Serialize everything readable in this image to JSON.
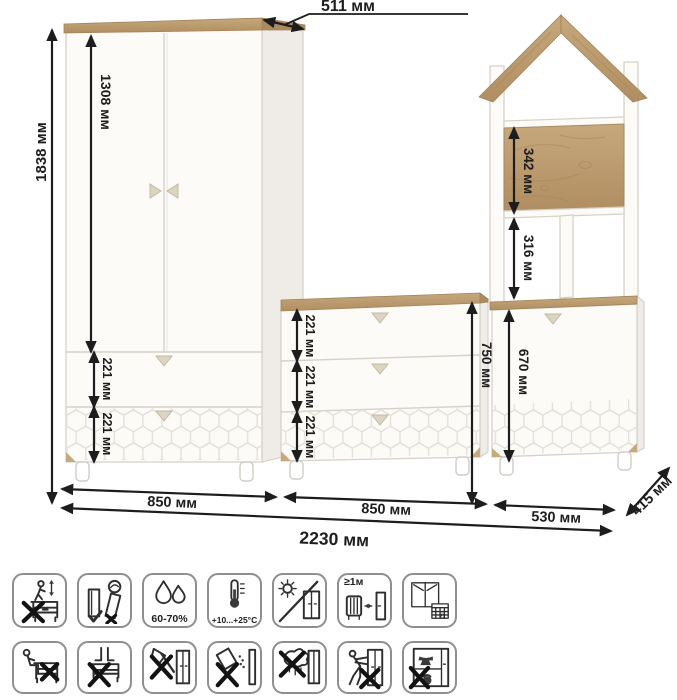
{
  "title": "furniture-set-dimension-diagram",
  "colors": {
    "oak": "#bb9a6f",
    "oak_dark": "#ab8c60",
    "panel_white": "#fcfbf8",
    "panel_outline": "#d5d2cb",
    "dimension_ink": "#1d1d1d",
    "honeycomb_line": "#e4e1da",
    "icon_border": "#8f8f8f"
  },
  "dimensions": {
    "top_depth": "511 мм",
    "total_height": "1838 мм",
    "door_height": "1308 мм",
    "drawer_height": "221 мм",
    "oak_shelf_height": "342 мм",
    "open_shelf_height": "316 мм",
    "chest_height": "750 мм",
    "right_door_height": "670 мм",
    "wardrobe_width": "850 мм",
    "chest_width": "850 мм",
    "right_cabinet_width": "530 мм",
    "total_width": "2230 мм",
    "depth": "415 мм"
  },
  "furniture": {
    "left_unit": "two-door wardrobe with two drawers",
    "middle_unit": "three-drawer chest",
    "right_unit": "house-shaped shelf with one-door cabinet"
  },
  "care_icons": {
    "row1": [
      {
        "name": "no-climbing"
      },
      {
        "name": "keep-upright-level"
      },
      {
        "name": "humidity-range",
        "label": "60-70%"
      },
      {
        "name": "temperature-range",
        "label": "+10...+25°C"
      },
      {
        "name": "avoid-direct-sunlight"
      },
      {
        "name": "min-distance-from-heater",
        "label": "≥1м"
      },
      {
        "name": "ventilation",
        "calendar_day": "21"
      }
    ],
    "row2": [
      {
        "name": "no-sitting"
      },
      {
        "name": "no-standing"
      },
      {
        "name": "no-sharp-tools"
      },
      {
        "name": "no-spilling"
      },
      {
        "name": "no-wet-cleaning"
      },
      {
        "name": "no-pushing"
      },
      {
        "name": "no-overloading"
      }
    ]
  }
}
